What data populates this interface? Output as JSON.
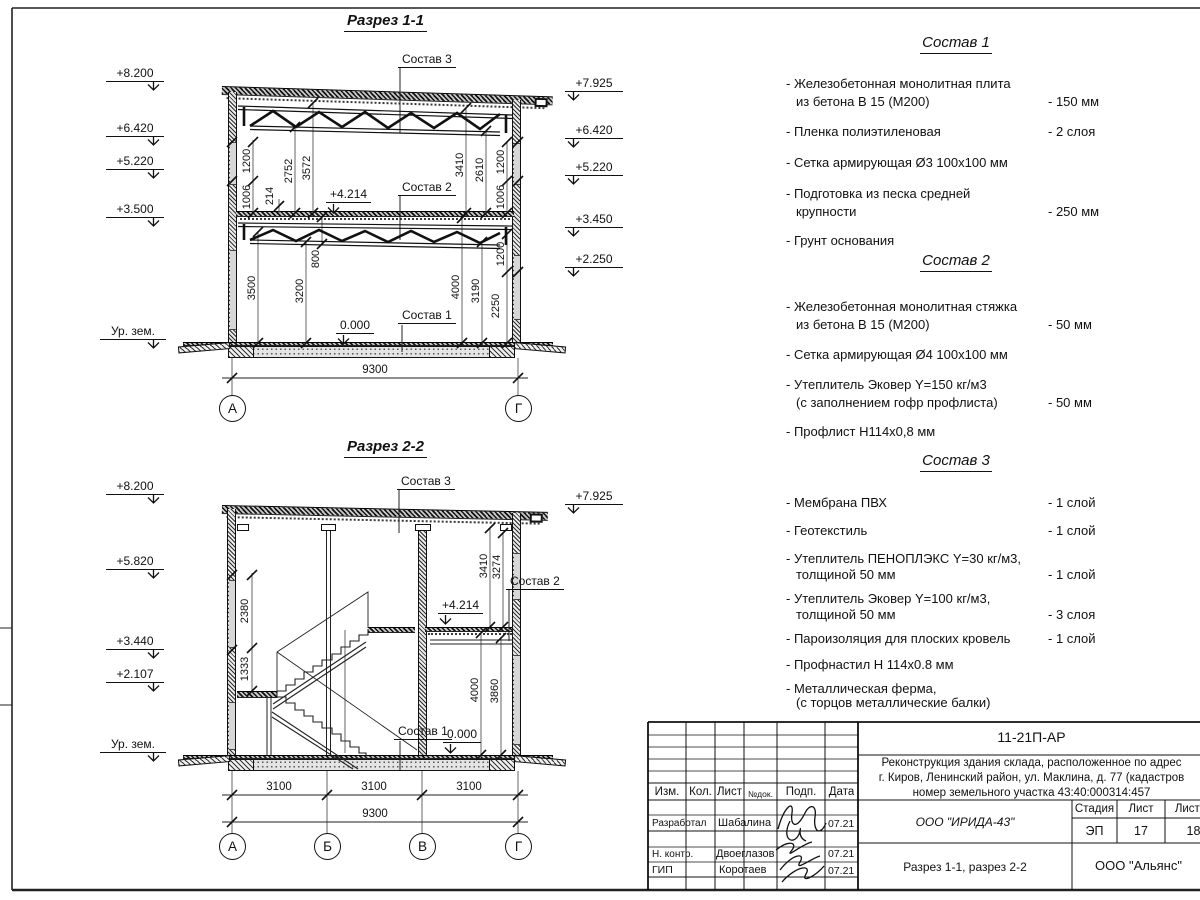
{
  "s1": {
    "title": "Разрез 1-1",
    "elev_left": [
      "+8.200",
      "+6.420",
      "+5.220",
      "+3.500"
    ],
    "ground": "Ур. зем.",
    "elev_right": [
      "+7.925",
      "+6.420",
      "+5.220",
      "+3.450",
      "+2.250"
    ],
    "sostav3": "Состав 3",
    "sostav2": "Состав 2",
    "sostav1": "Состав 1",
    "lvl_mid": "+4.214",
    "lvl_zero": "0.000",
    "dims_ul": [
      "1200",
      "1006",
      "214",
      "2752",
      "3572"
    ],
    "dims_ur": [
      "3410",
      "2610",
      "1200",
      "1006"
    ],
    "dims_ll": [
      "3500",
      "3200",
      "800"
    ],
    "dims_lr": [
      "4000",
      "3190",
      "2250",
      "1200"
    ],
    "total": "9300",
    "axes": [
      "А",
      "Г"
    ]
  },
  "s2": {
    "title": "Разрез 2-2",
    "elev_left": [
      "+8.200",
      "+5.820",
      "+3.440",
      "+2.107"
    ],
    "ground": "Ур. зем.",
    "elev_right": [
      "+7.925"
    ],
    "sostav3": "Состав 3",
    "sostav2": "Состав 2",
    "sostav1": "Состав 1",
    "lvl_mid": "+4.214",
    "lvl_zero": "0.000",
    "dims_l": [
      "2380",
      "1333"
    ],
    "dims_ru": [
      "3410",
      "3274"
    ],
    "dims_rl": [
      "4000",
      "3860"
    ],
    "dims_b": [
      "3100",
      "3100",
      "3100"
    ],
    "total": "9300",
    "axes": [
      "А",
      "Б",
      "В",
      "Г"
    ]
  },
  "s_1": {
    "title": "Состав 1",
    "items": [
      {
        "l1": "- Железобетонная  монолитная плита",
        "l2": "из бетона В 15 (М200)",
        "v": "- 150 мм"
      },
      {
        "l1": "- Пленка полиэтиленовая",
        "v": "-  2 слоя"
      },
      {
        "l1": "- Сетка армирующая Ø3 100х100 мм"
      },
      {
        "l1": "- Подготовка из песка средней",
        "l2": "крупности",
        "v": "- 250 мм"
      },
      {
        "l1": "- Грунт основания"
      }
    ]
  },
  "s_2": {
    "title": "Состав 2",
    "items": [
      {
        "l1": "- Железобетонная  монолитная стяжка",
        "l2": "из бетона В 15 (М200)",
        "v": "- 50 мм"
      },
      {
        "l1": "- Сетка армирующая Ø4 100х100 мм"
      },
      {
        "l1": "- Утеплитель Эковер Y=150 кг/м3",
        "l2": "(с заполнением гофр профлиста)",
        "v": "- 50 мм"
      },
      {
        "l1": "- Профлист Н114х0,8 мм"
      }
    ]
  },
  "s_3": {
    "title": "Состав 3",
    "items": [
      {
        "l1": "- Мембрана ПВХ",
        "v": "- 1 слой"
      },
      {
        "l1": "- Геотекстиль",
        "v": "- 1 слой"
      },
      {
        "l1": "- Утеплитель ПЕНОПЛЭКС Y=30 кг/м3,",
        "l2": "толщиной 50 мм",
        "v": "- 1 слой"
      },
      {
        "l1": "- Утеплитель Эковер Y=100 кг/м3,",
        "l2": "толщиной 50 мм",
        "v": "- 3 слоя"
      },
      {
        "l1": "- Пароизоляция для плоских кровель",
        "v": "- 1 слой"
      },
      {
        "l1": "- Профнастил Н 114х0.8 мм"
      },
      {
        "l1": "- Металлическая ферма,",
        "l2": "(с торцов металлические балки)"
      }
    ]
  },
  "tb": {
    "doc": "11-21П-АР",
    "desc1": "Реконструкция здания склада, расположенное по адрес",
    "desc2": "г. Киров, Ленинский район, ул. Маклина, д. 77 (кадастров",
    "desc3": "номер земельного участка 43:40:000314:457",
    "h_izm": "Изм.",
    "h_kol": "Кол.",
    "h_list": "Лист",
    "h_ndok": "№док.",
    "h_podp": "Подп.",
    "h_data": "Дата",
    "r1_role": "Разработал",
    "r1_name": "Шабалина",
    "r1_date": "07.21",
    "r2_role": "Н. контр.",
    "r2_name": "Двоеглазов",
    "r2_date": "07.21",
    "r3_role": "ГИП",
    "r3_name": "Коротаев",
    "r3_date": "07.21",
    "org": "ООО \"ИРИДА-43\"",
    "h_stage": "Стадия",
    "h_sheet": "Лист",
    "h_sheets": "Листов",
    "stage": "ЭП",
    "sheet": "17",
    "sheets": "18",
    "sheet_title": "Разрез 1-1, разрез 2-2",
    "company": "ООО \"Альянс\""
  }
}
